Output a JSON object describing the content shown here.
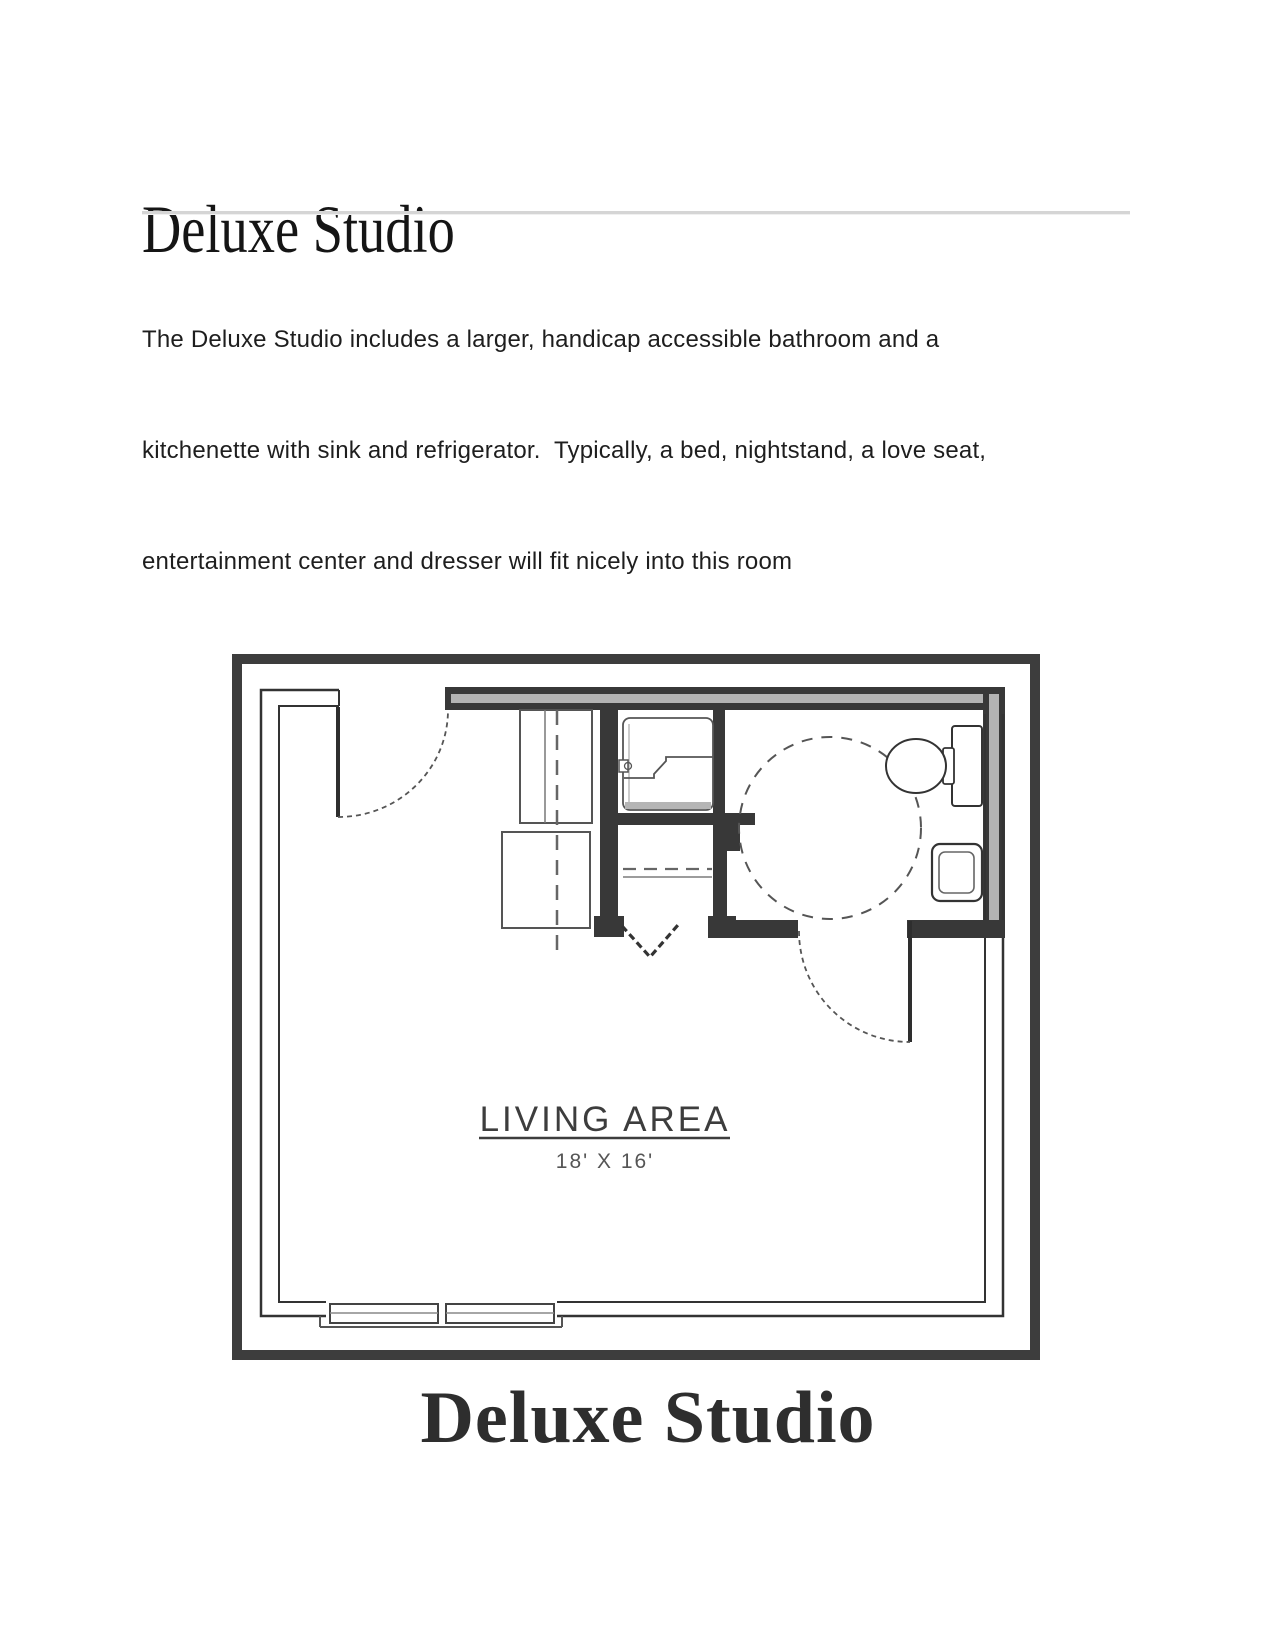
{
  "document": {
    "title": "Deluxe Studio",
    "description_lines": [
      "The Deluxe Studio includes a larger, handicap accessible bathroom and a",
      "kitchenette with sink and refrigerator.  Typically, a bed, nightstand, a love seat,",
      "entertainment center and dresser will fit nicely into this room"
    ]
  },
  "floor_plan": {
    "label": "LIVING AREA",
    "dimensions": "18' X 16'",
    "caption": "Deluxe Studio",
    "features": [
      "entry-door",
      "kitchenette-counter",
      "refrigerator",
      "shower",
      "closet",
      "bathroom-door",
      "wheelchair-turning-circle",
      "toilet",
      "sink",
      "window"
    ]
  },
  "colors": {
    "frame": "#3d3d3d",
    "wall": "#383838",
    "line": "#333333",
    "core": "#b3b3b3",
    "rule": "#d5d5d5",
    "body_text": "#1e1e1e",
    "title_text": "#151515",
    "caption_text": "#2e2e2e",
    "plan_text": "#3d3d3d"
  }
}
